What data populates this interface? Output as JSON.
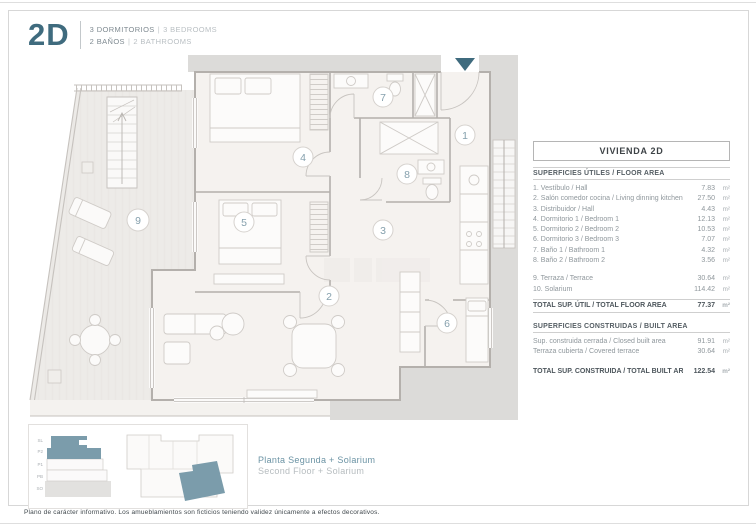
{
  "header": {
    "code": "2D",
    "sep": "|",
    "bedrooms_es": "3 DORMITORIOS",
    "bedrooms_en": "3 BEDROOMS",
    "bathrooms_es": "2 BAÑOS",
    "bathrooms_en": "2 BATHROOMS"
  },
  "plan": {
    "room_labels": [
      "1",
      "2",
      "3",
      "4",
      "5",
      "6",
      "7",
      "8",
      "9"
    ]
  },
  "table": {
    "title": "VIVIENDA 2D",
    "floor_area": {
      "section": "SUPERFICIES ÚTILES / FLOOR AREA",
      "rows": [
        {
          "label": "1. Vestíbulo / Hall",
          "value": "7.83",
          "unit": "m²"
        },
        {
          "label": "2. Salón comedor cocina / Living dinning kitchen",
          "value": "27.50",
          "unit": "m²"
        },
        {
          "label": "3. Distribuidor / Hall",
          "value": "4.43",
          "unit": "m²"
        },
        {
          "label": "4. Dormitorio 1 / Bedroom 1",
          "value": "12.13",
          "unit": "m²"
        },
        {
          "label": "5. Dormitorio 2 / Bedroom 2",
          "value": "10.53",
          "unit": "m²"
        },
        {
          "label": "6. Dormitorio 3 / Bedroom 3",
          "value": "7.07",
          "unit": "m²"
        },
        {
          "label": "7. Baño 1 / Bathroom 1",
          "value": "4.32",
          "unit": "m²"
        },
        {
          "label": "8. Baño 2 / Bathroom 2",
          "value": "3.56",
          "unit": "m²"
        }
      ],
      "outdoor_rows": [
        {
          "label": "9. Terraza / Terrace",
          "value": "30.64",
          "unit": "m²"
        },
        {
          "label": "10. Solarium",
          "value": "114.42",
          "unit": "m²"
        }
      ],
      "total": {
        "label": "TOTAL SUP. ÚTIL / TOTAL FLOOR AREA",
        "value": "77.37",
        "unit": "m²"
      }
    },
    "built_area": {
      "section": "SUPERFICIES CONSTRUIDAS / BUILT AREA",
      "rows": [
        {
          "label": "Sup. construida cerrada / Closed built area",
          "value": "91.91",
          "unit": "m²"
        },
        {
          "label": "Terraza cubierta / Covered terrace",
          "value": "30.64",
          "unit": "m²"
        }
      ],
      "total": {
        "label": "TOTAL SUP. CONSTRUIDA /  TOTAL BUILT AREA",
        "value": "122.54",
        "unit": "m²"
      }
    }
  },
  "minimap": {
    "floors": [
      "SL",
      "P2",
      "P1",
      "PB",
      "SO"
    ],
    "caption_es": "Planta Segunda + Solarium",
    "caption_en": "Second Floor + Solarium"
  },
  "footer": {
    "disclaimer": "Plano de carácter informativo. Los amueblamientos son ficticios teniendo validez únicamente a efectos decorativos."
  },
  "colors": {
    "accent": "#3f6b7e",
    "accent_soft": "#7b9cab",
    "wall_gray": "#b4b0ac",
    "band_gray": "#dcdbd9",
    "text_dark": "#4d565c",
    "text_gray": "#8f979c",
    "text_light": "#b9bfc3"
  }
}
